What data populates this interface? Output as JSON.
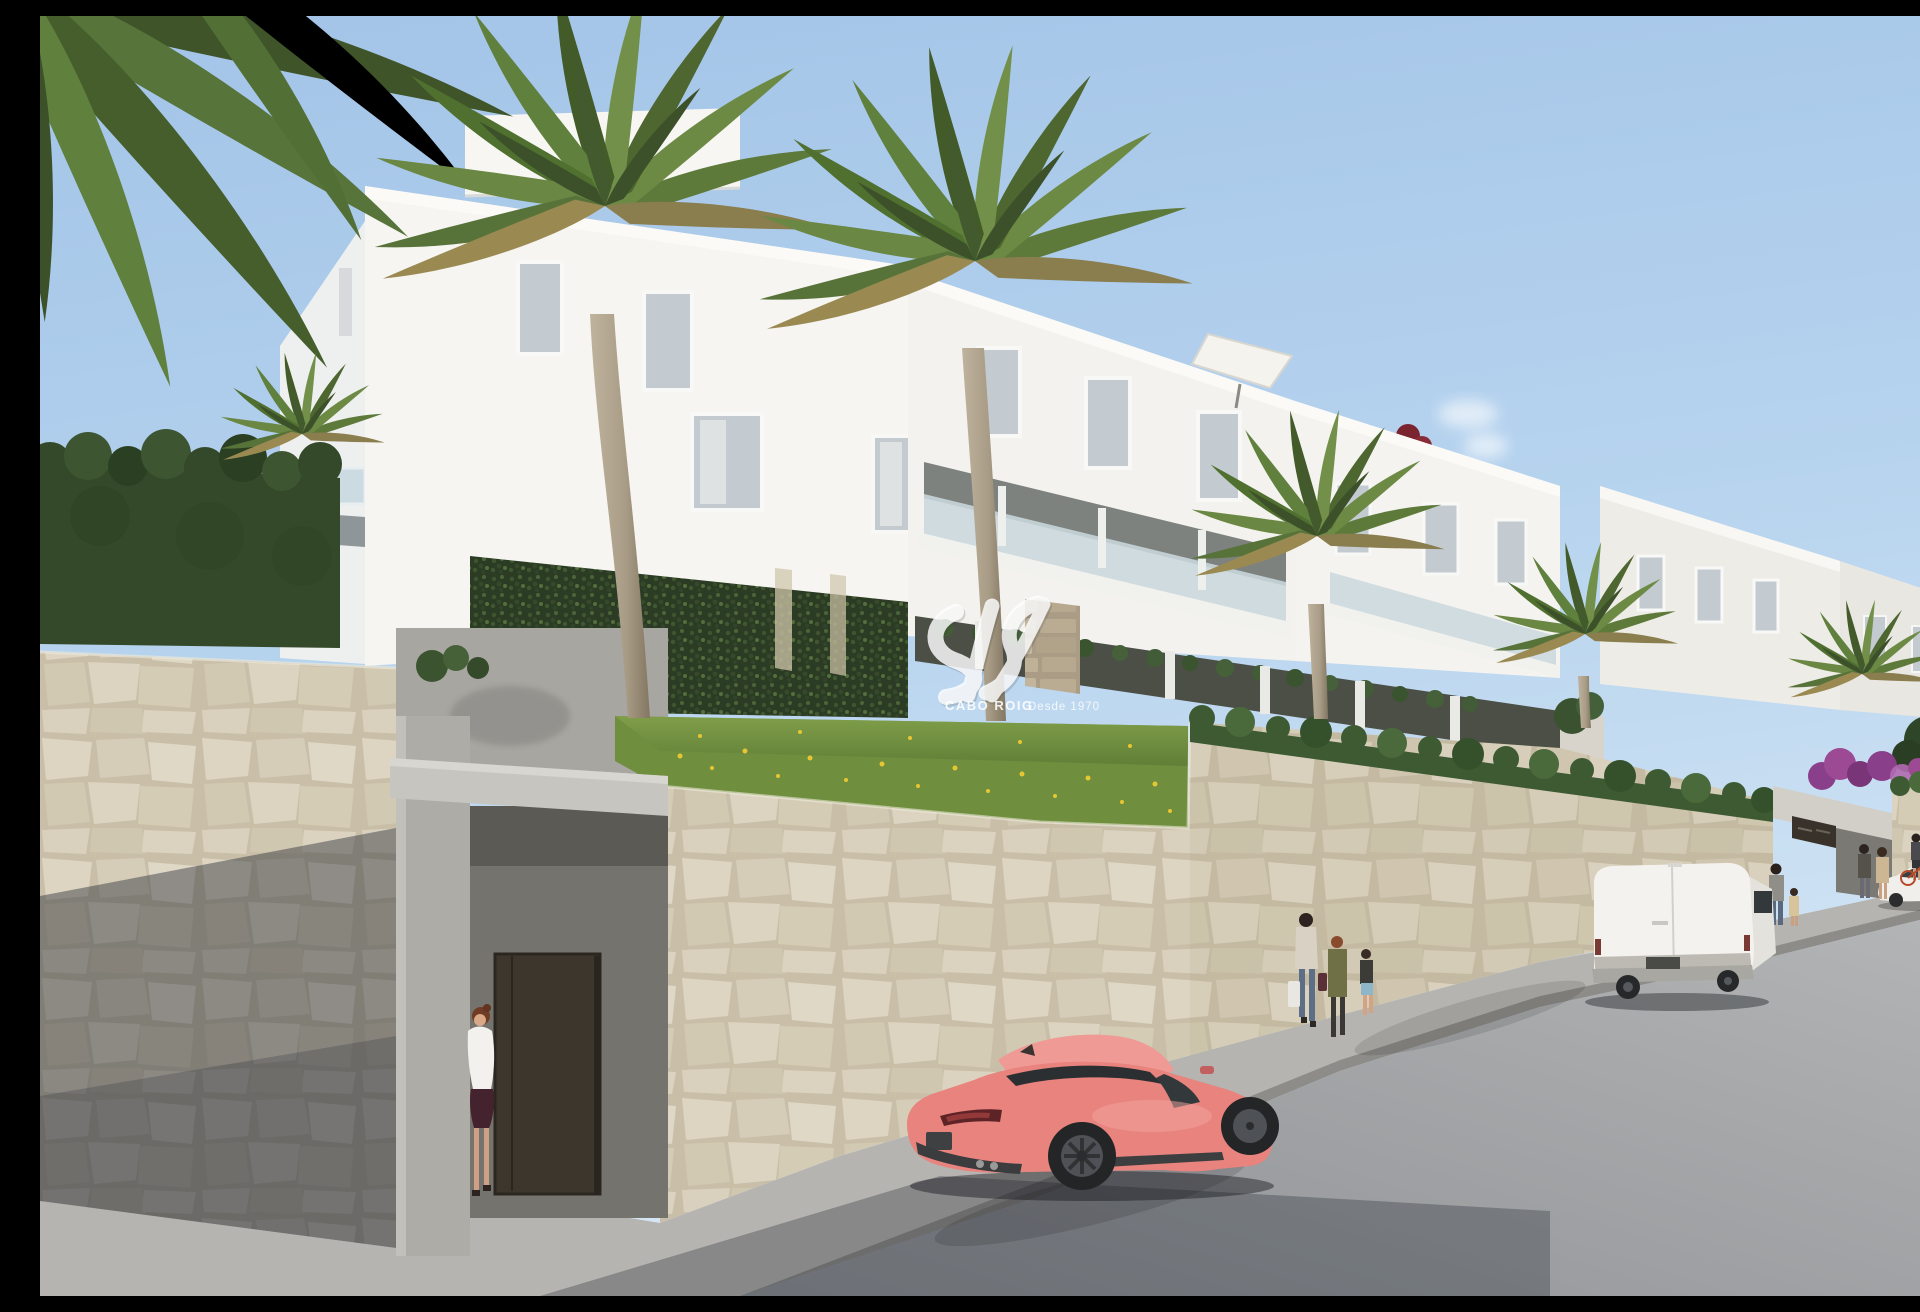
{
  "watermark": {
    "brand": "CABO ROIG",
    "tagline": "Desde 1970",
    "logo": "white semi-transparent script monogram above text"
  },
  "palette": {
    "sky_top": "#a3c4e8",
    "sky_horizon": "#d6e7f5",
    "cloud_white": "#ffffff",
    "building_white": "#f6f5f1",
    "building_shade": "#eef0ef",
    "glass_balcony": "#c9d7dd",
    "stone_sunlit_joint": "#c9bfa9",
    "concrete": "#b5b3ad",
    "hedge_green": "#3e5a33",
    "hedge_dark": "#33492a",
    "ivy_green": "#2c3b24",
    "palm_green": "#5d7a3a",
    "palm_dry": "#8a7d4e",
    "grass_green": "#6f8e3e",
    "flower_yellow": "#e7c633",
    "trunk_tan": "#b2a68f",
    "road_gray": "#a0a2a4",
    "sidewalk_gray": "#b6b4b0",
    "curb_gray": "#8e8c88",
    "deep_shadow": "#1f2330",
    "car_coral": "#e8837e",
    "car_glass": "#2b2f31",
    "van_white": "#f3f2ef",
    "sedan_white": "#f0efec",
    "door_brown": "#3d362c",
    "plaque_dark": "#38322a",
    "bougainvillea_purple": "#8a3f8a",
    "bougainvillea_red": "#7a2430",
    "umbrella_white": "#f4f3ee"
  },
  "scene": {
    "setting": "street-level render of a white Mediterranean new-build apartment complex on a hillside",
    "sky": {
      "description": "clear blue sky with one small wispy cloud",
      "cloud_count": 1
    },
    "buildings": {
      "visible_blocks": 5,
      "features": [
        "stepped white facades",
        "glass balcony balustrades",
        "roof terraces",
        "white parasol on roof terrace",
        "red bougainvillea on parapet"
      ]
    },
    "vegetation": [
      "tall fan palms in front of the facade",
      "overhanging palm fronds in top-left corner",
      "dense clipped hedge on the left boundary wall",
      "ivy-covered garden wall below the building",
      "grass bank dotted with yellow wildflowers",
      "hedge row along the top of the street wall",
      "purple bougainvillea at the far right"
    ],
    "walls": [
      "cream natural-stone retaining walls along the street",
      "concrete pedestrian entrance with dark brown gate and steps (left)",
      "stone entrance portal with dark sign plaque, text not legible (right)"
    ],
    "street": [
      "asphalt road sloping down to the right",
      "sunlit sidewalk along the wall",
      "deep foreground shadow at bottom left"
    ],
    "vehicles": [
      {
        "name": "coral sports coupe",
        "color_hex": "#e8837e",
        "position": "parked centre foreground, rear three-quarter view, dark alloy wheels"
      },
      {
        "name": "white panel van",
        "color_hex": "#f3f2ef",
        "position": "parked on the right side of the street, rear view"
      },
      {
        "name": "white sedan",
        "color_hex": "#f0efec",
        "position": "far right beside the entrance portal"
      }
    ],
    "people": [
      {
        "name": "woman entering gate",
        "detail": "white blouse, dark maroon skirt, auburn hair"
      },
      {
        "name": "woman with shopping bags",
        "detail": "light top, blue jeans, white and dark bags"
      },
      {
        "name": "adult in olive jacket",
        "detail": "dark trousers, walking with group"
      },
      {
        "name": "child in light-blue shorts",
        "detail": "dark top"
      },
      {
        "name": "man walking with small child",
        "detail": "grey t-shirt, near the van"
      },
      {
        "name": "couple standing at entrance portal"
      },
      {
        "name": "person with red bicycle"
      }
    ]
  }
}
